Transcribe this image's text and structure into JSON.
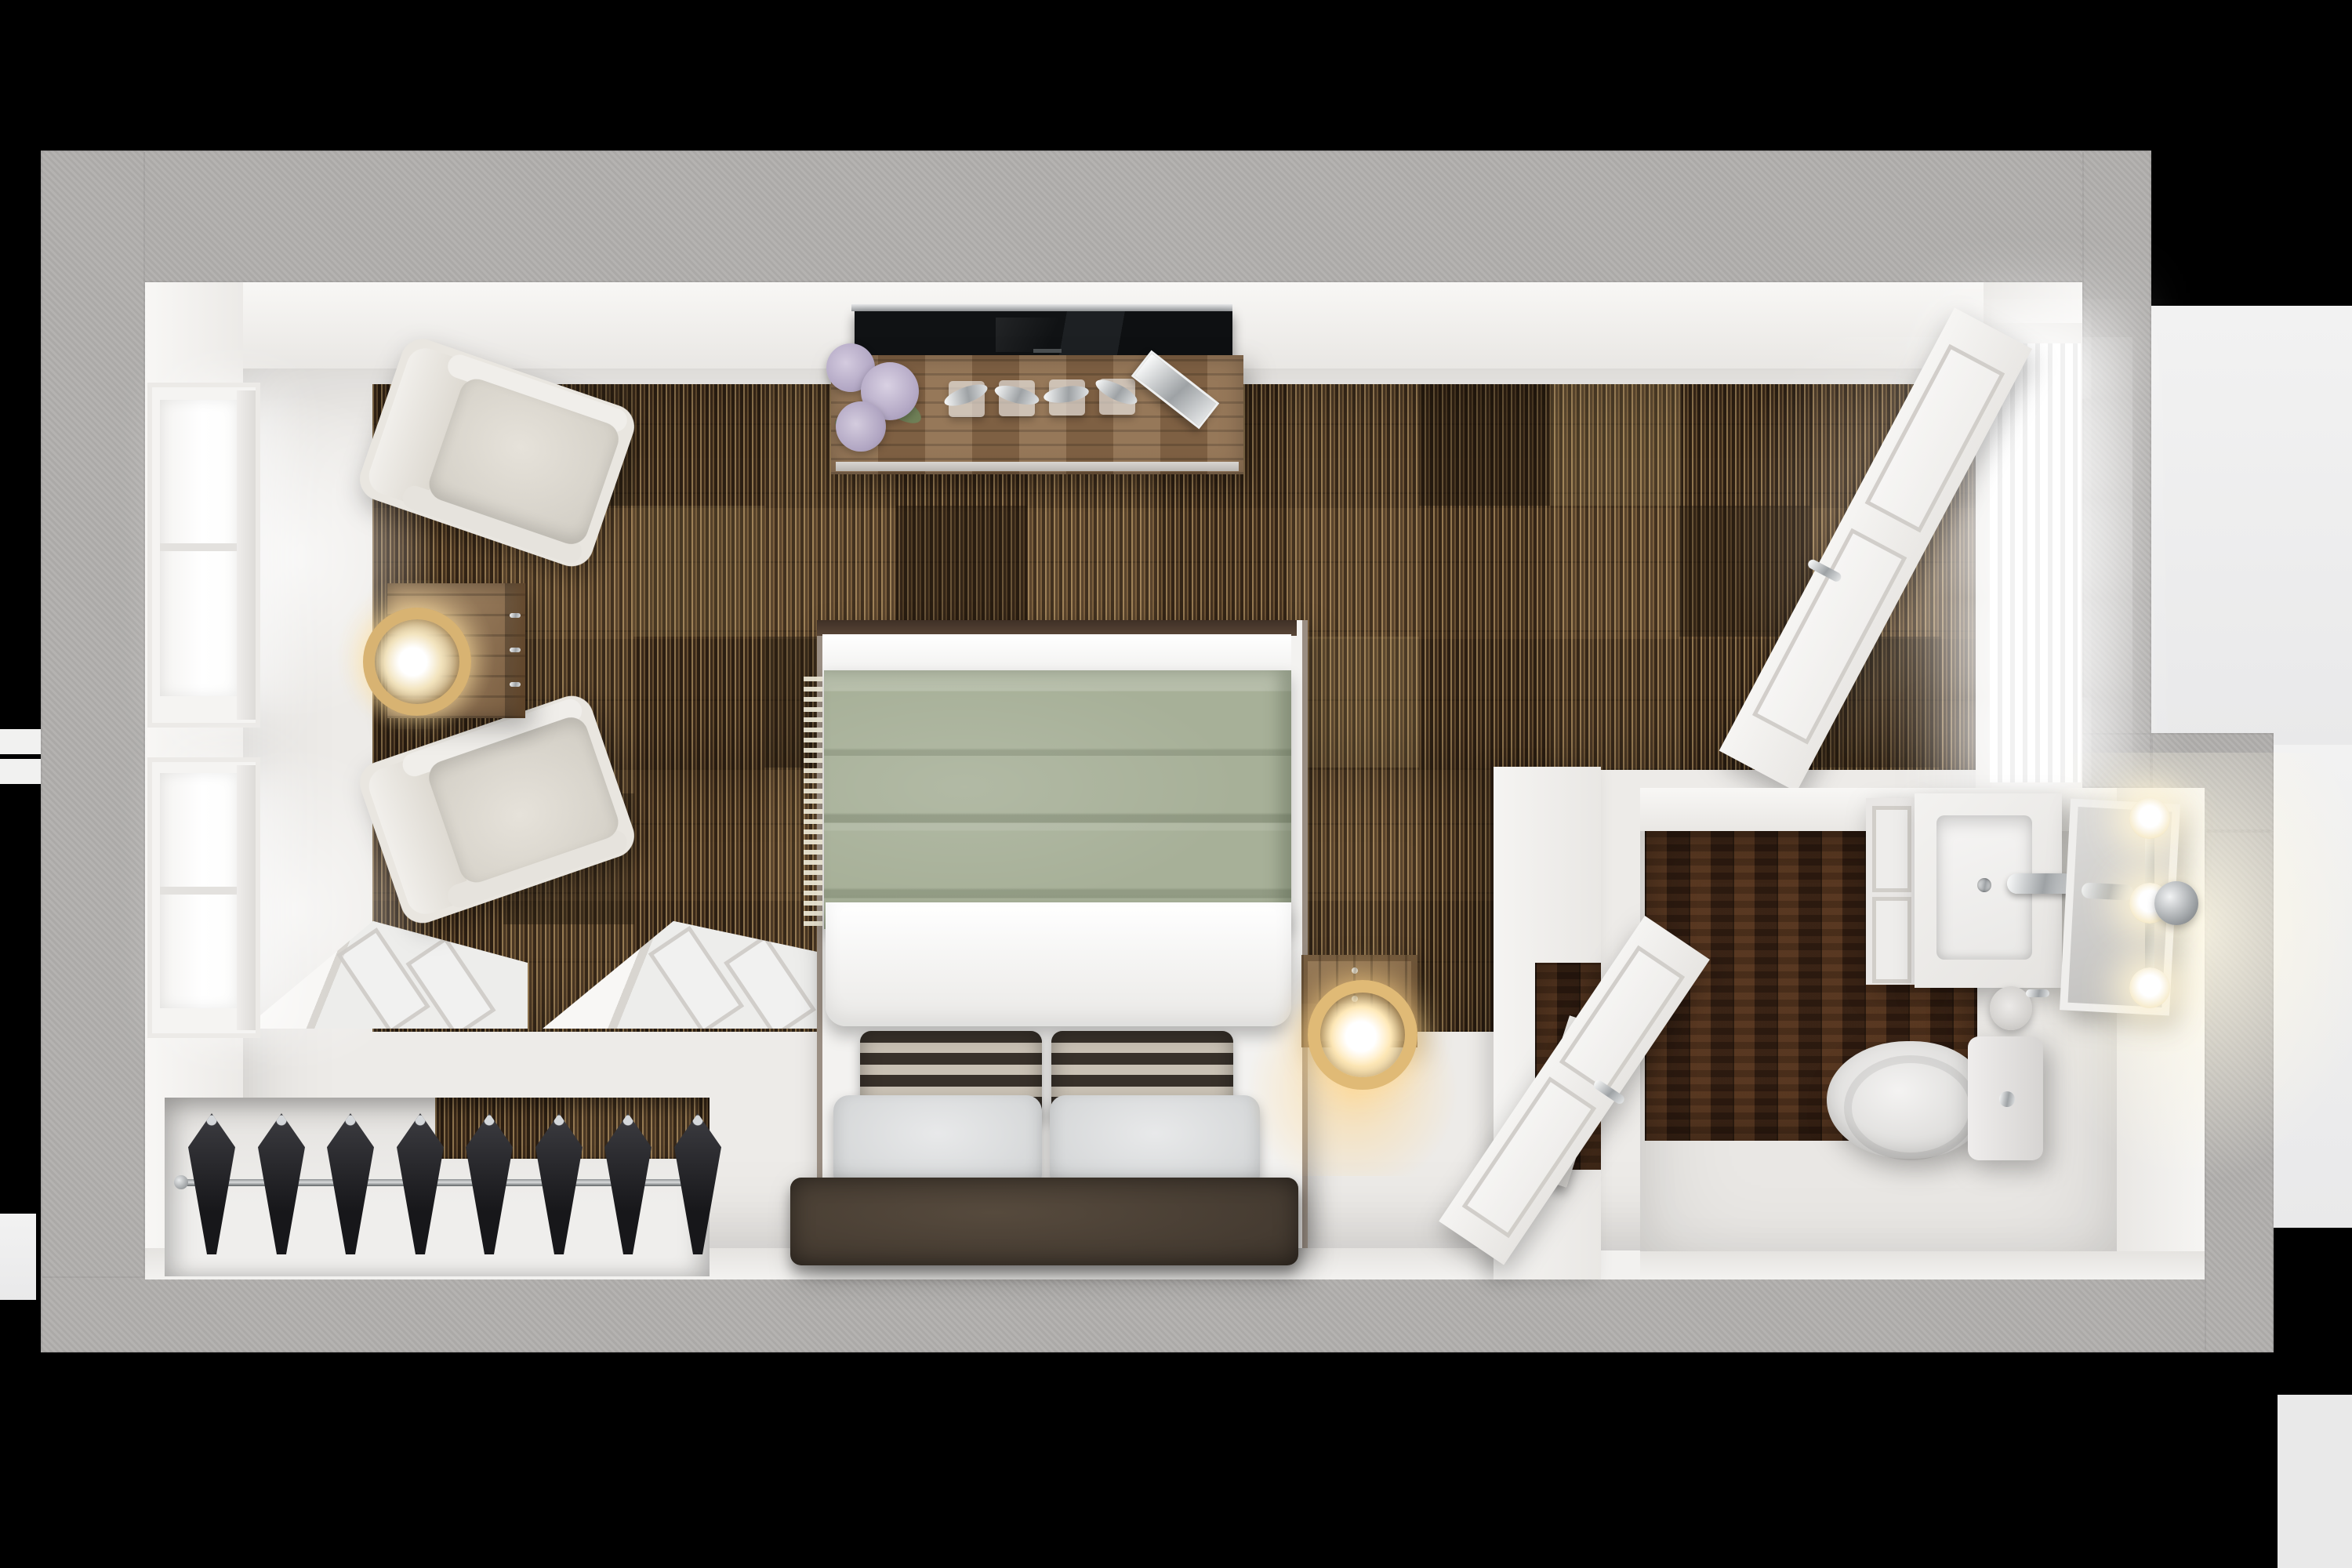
{
  "scene": {
    "kind": "photorealistic top-down 3D floor-plan render",
    "rooms": [
      {
        "name": "bedroom",
        "floor": "striped patchwork carpet over white painted border"
      },
      {
        "name": "closet",
        "contents": [
          "hanging rod",
          "8 black hangers",
          "2 folded bifold doors"
        ]
      },
      {
        "name": "bathroom",
        "floor": "dark walnut planks with white border"
      }
    ]
  },
  "palette": {
    "black": "#000000",
    "bgwhite": "#eeeeef",
    "gray": "#b2b0ae",
    "wallwhite": "#f2f1ef",
    "floor": "#edebe8",
    "carpetbase": "#513b25",
    "carpetlight": "#c9a36b",
    "wood": "#3a2214",
    "consolewood": "#8a6a4b",
    "green": "#a7b098",
    "duvet": "#f4f3f0",
    "pillowgray": "#dfddda",
    "headboard": "#4b4036",
    "chair": "#e9e6e0",
    "chairseat": "#d8d4cb",
    "gold": "#d8b372",
    "chromecol": "#c9cbcd",
    "tv": "#131518",
    "flower": "#b3a8c5",
    "leaf": "#6f7f57",
    "door": "#f3f2ef",
    "hanger": "#232327"
  },
  "inventory": {
    "windows": 2,
    "armchairs": 2,
    "side_table": 1,
    "table_lamp": 1,
    "tv": 1,
    "media_console": 1,
    "flower_bouquet_heads": 3,
    "chrome_figurines": 4,
    "chrome_tray": 1,
    "bed": {
      "blanket": "sage green throw",
      "duvet": "white",
      "striped_pillows": 2,
      "gray_pillows": 2,
      "headboard": "dark leather"
    },
    "nightstand": 1,
    "nightstand_ring_lamp": 1,
    "closet_hangers": 8,
    "bifold_doors": 2,
    "entry_door": 1,
    "bathroom": {
      "vanity_sink": 1,
      "faucet": 1,
      "mirror": 1,
      "sconce_bulbs": 3,
      "toilet": 1,
      "paper_roll": 1,
      "door": 1
    }
  }
}
